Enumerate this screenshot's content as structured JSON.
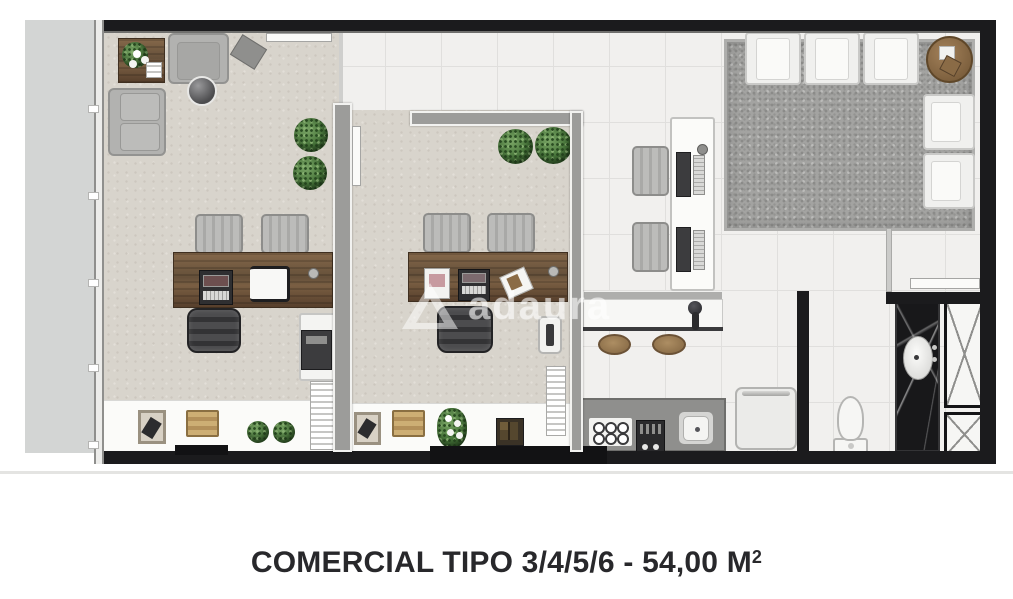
{
  "caption": {
    "text": "COMERCIAL TIPO 3/4/5/6 - 54,00 M",
    "superscript": "2",
    "color": "#28282b"
  },
  "watermark": {
    "text": "adaura",
    "logo": "triangle-a-logo",
    "color": "#ffffff",
    "opacity": 0.55
  },
  "floorplan": {
    "type": "commercial-office-floor-plan",
    "unit_types": "3/4/5/6",
    "area": "54,00 M²",
    "colors": {
      "outer_wall": "#1b1b1d",
      "inner_wall": "#9c9c9a",
      "carpet_beige": "#d8d4cc",
      "tile_white": "#f1f0ee",
      "rug_gray": "#a3a3a1",
      "wood_brown": "#6f563c",
      "granite_gray": "#8f8f8d",
      "marble_black": "#18181a",
      "plant_green": "#47763a"
    },
    "rooms": [
      {
        "name": "office-1",
        "floor": "beige-carpet",
        "furniture": [
          "side-table-with-plant",
          "armchair",
          "magazine-tray",
          "round-coffee-table",
          "wall-sofa",
          "two-plants",
          "wood-desk",
          "laptop",
          "tablet",
          "two-guest-chairs",
          "executive-chair",
          "sideboard-with-printer",
          "magazine-rack",
          "decor-frame",
          "wood-crate",
          "two-small-plants"
        ]
      },
      {
        "name": "office-2",
        "floor": "beige-carpet",
        "furniture": [
          "two-plants",
          "wood-desk",
          "coffee-machine",
          "laptop",
          "papers",
          "two-guest-chairs",
          "executive-chair",
          "water-cooler",
          "shelf-stack",
          "decor-frame",
          "wood-crate",
          "flower-plant",
          "storage-box"
        ]
      },
      {
        "name": "reception-lounge",
        "floor": "white-tile",
        "furniture": [
          "shag-rug",
          "three-lounge-seats",
          "round-side-table",
          "two-armchairs",
          "workstation-desk",
          "two-monitors",
          "two-keyboards",
          "two-task-chairs"
        ]
      },
      {
        "name": "kitchenette",
        "floor": "white-tile",
        "furniture": [
          "bar-counter",
          "bar-faucet",
          "two-stools",
          "granite-counter",
          "six-burner-cooktop",
          "small-oven",
          "sink",
          "refrigerator"
        ]
      },
      {
        "name": "bathroom",
        "floor": "white-tile",
        "furniture": [
          "toilet",
          "black-marble-vanity",
          "oval-sink",
          "entry-door"
        ]
      },
      {
        "name": "service-shafts",
        "furniture": [
          "large-x-duct",
          "small-x-duct"
        ]
      }
    ],
    "features": [
      "window-wall-left",
      "balcony-slab-left",
      "entry-notch-office-1",
      "entry-notch-office-2",
      "open-doors"
    ]
  }
}
